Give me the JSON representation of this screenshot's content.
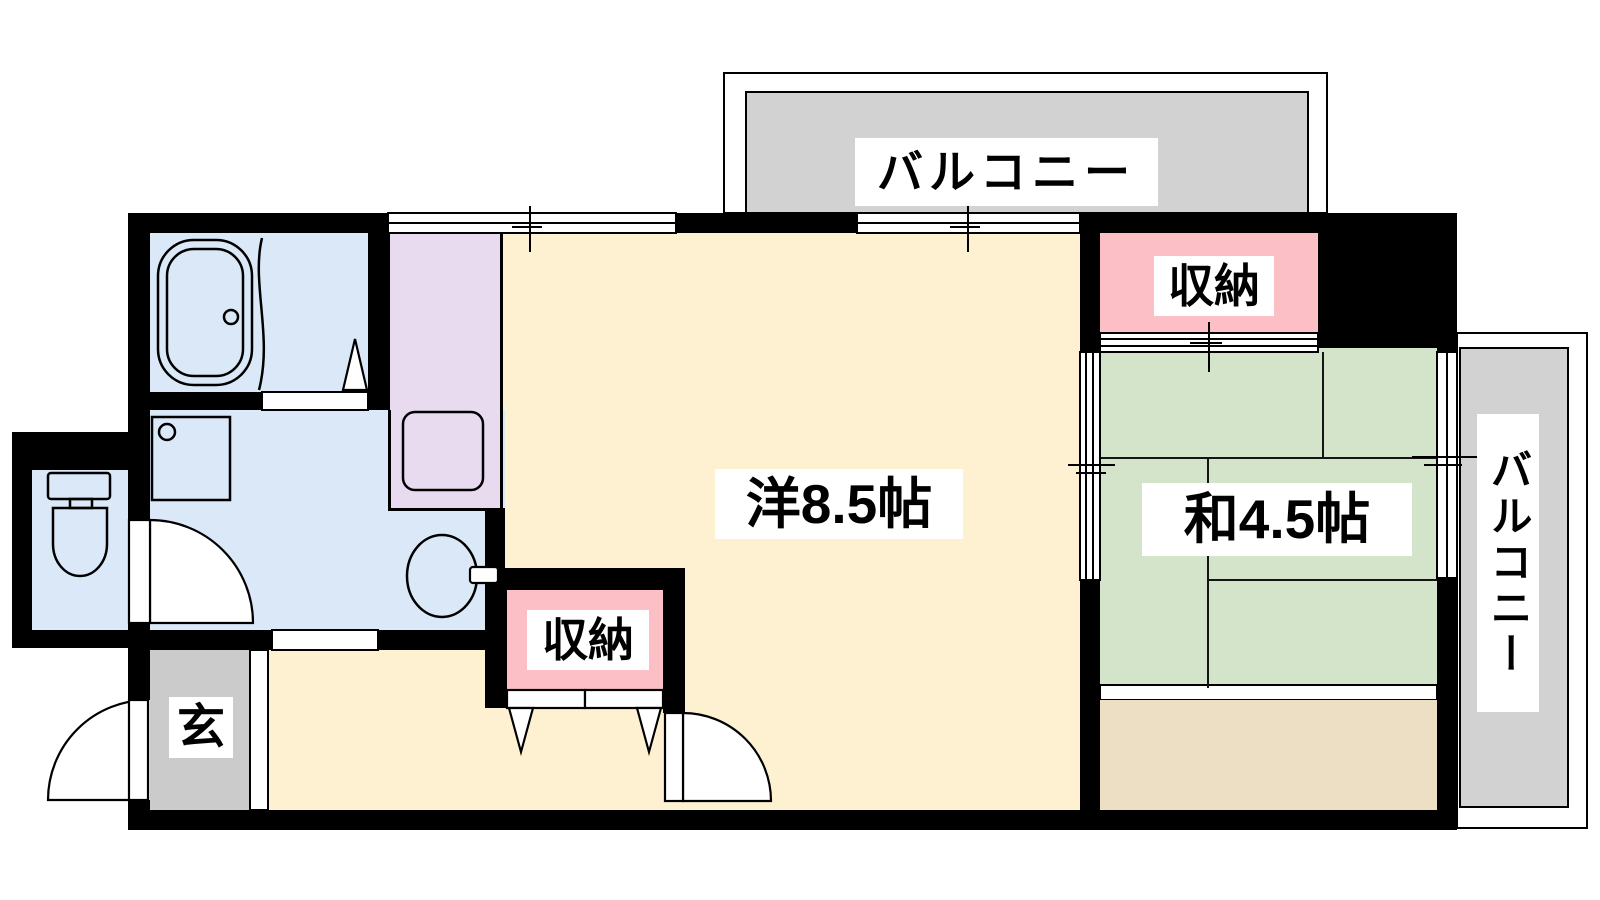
{
  "floorplan": {
    "rooms": {
      "western_room_label": "洋8.5帖",
      "japanese_room_label": "和4.5帖",
      "closet_main_label": "収納",
      "closet_japanese_label": "収納",
      "entrance_label": "玄",
      "balcony_top_label": "バルコニー",
      "balcony_right_label": "バルコニー"
    },
    "colors": {
      "wall": "#000000",
      "western_room": "#FDF1D1",
      "wet_area": "#DAE8F8",
      "kitchen": "#E8DBF0",
      "closet": "#FBBFC5",
      "tatami": "#D3E4CB",
      "wood_floor": "#EDDFC3",
      "balcony": "#D2D2D2",
      "entrance_floor": "#CBCBCB",
      "label_bg": "#FFFFFF"
    }
  }
}
